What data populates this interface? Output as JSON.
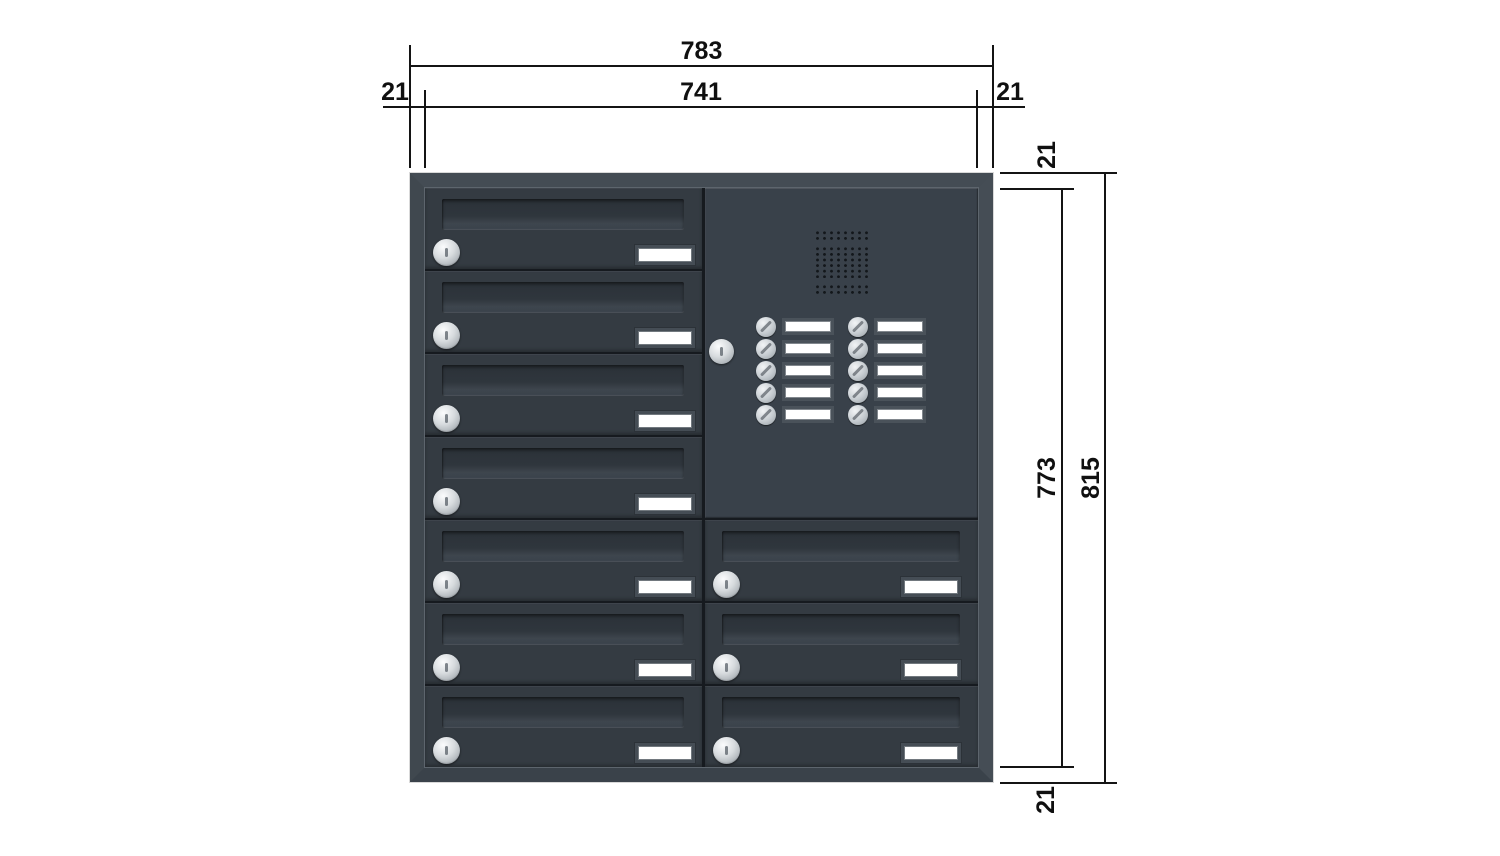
{
  "dims": {
    "unit_note": "783",
    "top_total": "783",
    "top_inner": "741",
    "top_left": "21",
    "top_right": "21",
    "right_top": "21",
    "right_inner": "773",
    "right_total": "815",
    "right_bottom": "21"
  },
  "cabinet": {
    "left_door_count": 7,
    "right_door_count": 3,
    "bell_rows": 5,
    "bell_cols": 2,
    "colors": {
      "door_face": "#343b42",
      "panel_face": "#39414a",
      "frame_face": "#3d454d",
      "frame_highlight": "#5d656d",
      "seam": "#161a1f",
      "lock_silver": "#d7dbde",
      "plate_white": "#ffffff",
      "dimension_ink": "#141414",
      "background": "#ffffff"
    }
  }
}
